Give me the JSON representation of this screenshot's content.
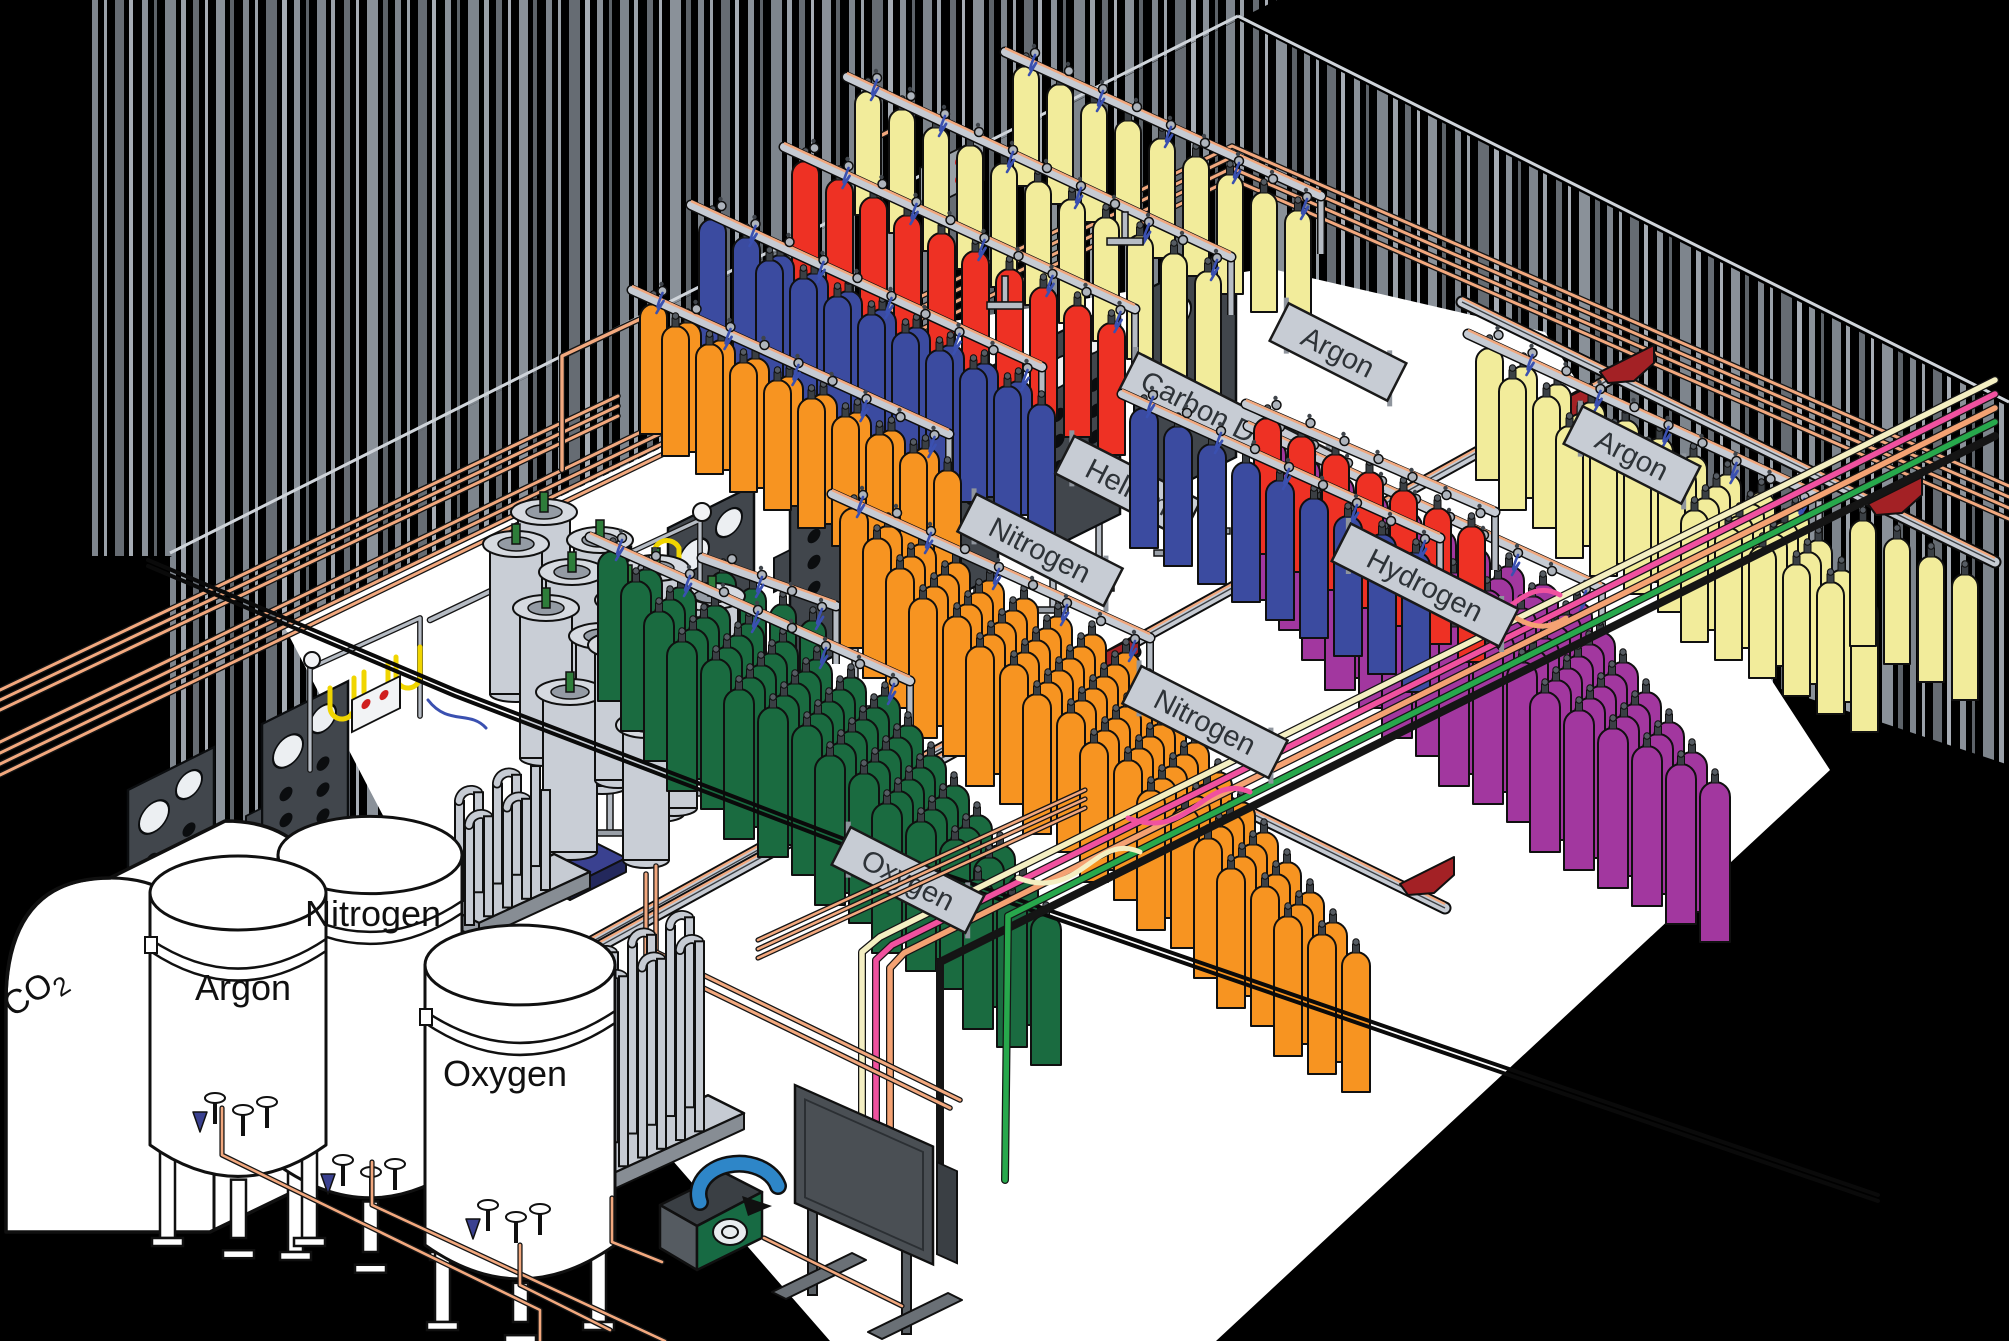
{
  "diagram": {
    "type": "isometric industrial gas cylinder filling plant",
    "description": "Warehouse with corrugated walls, rows of color-coded gas cylinder filling racks, cryogenic bulk tanks, vaporizers, dewars and overhead gas piping"
  },
  "signs": [
    {
      "id": "rack-sign-oxygen-a",
      "label": "Oxygen"
    },
    {
      "id": "rack-sign-nitrogen-a",
      "label": "Nitrogen"
    },
    {
      "id": "rack-sign-helium",
      "label": "Helium"
    },
    {
      "id": "rack-sign-carbon-dioxide",
      "label": "Carbon Dioxide"
    },
    {
      "id": "rack-sign-argon-a",
      "label": "Argon"
    },
    {
      "id": "rack-sign-oxygen-b",
      "label": "Oxygen"
    },
    {
      "id": "rack-sign-nitrogen-b",
      "label": "Nitrogen"
    },
    {
      "id": "rack-sign-hydrogen",
      "label": "Hydrogen"
    },
    {
      "id": "rack-sign-argon-b",
      "label": "Argon"
    }
  ],
  "tanks": [
    {
      "id": "tank-co2",
      "label_main": "CO",
      "label_sub": "2"
    },
    {
      "id": "tank-argon",
      "label": "Argon"
    },
    {
      "id": "tank-nitrogen",
      "label": "Nitrogen"
    },
    {
      "id": "tank-oxygen",
      "label": "Oxygen"
    }
  ],
  "colors": {
    "green": "#1A6B40",
    "orange": "#F79421",
    "blue": "#3B4BA0",
    "red": "#EE3124",
    "yellow": "#F2EC9B",
    "purple": "#A2379F",
    "copper": "#F2A87E",
    "rail": "#C6CBD3",
    "railDark": "#AEB4BC",
    "sign": "#C7CCD4",
    "signText": "#2E3338",
    "hose": "#3A50B0",
    "hopper": "#A32125",
    "pallet": "#3A4190",
    "dewar": "#C9CED6",
    "stem": "#2E7D3A",
    "pumpGreen": "#176A43",
    "pumpBlue": "#2E86C8",
    "panel": "#41464C",
    "cream": "#F4EFC2",
    "pink": "#F0519F",
    "pipeOrange": "#F4A273",
    "pipeGreen": "#27A84C",
    "floor": "#FFFFFF",
    "yellowHose": "#F0D500"
  },
  "scene": {
    "rows_a": [
      [
        "yellow",
        9,
        1285,
        330,
        -34,
        -18,
        26,
        120,
        1,
        1
      ],
      [
        "yellow",
        11,
        1195,
        395,
        -34,
        -18,
        26,
        124,
        1,
        1
      ],
      [
        "red",
        10,
        1098,
        455,
        -34,
        -18,
        27,
        132,
        1,
        1
      ],
      [
        "blue",
        10,
        1005,
        515,
        -34,
        -18,
        27,
        134,
        1,
        1
      ],
      [
        "blue",
        9,
        1028,
        538,
        -34,
        -18,
        27,
        134,
        0,
        0
      ],
      [
        "orange",
        9,
        912,
        578,
        -34,
        -18,
        27,
        130,
        1,
        1
      ],
      [
        "orange",
        9,
        934,
        600,
        -34,
        -18,
        27,
        130,
        0,
        0
      ],
      [
        "green",
        4,
        800,
        745,
        -30,
        -16,
        26,
        125,
        1,
        1
      ]
    ],
    "rows_b": [
      [
        "yellow",
        10,
        1782,
        642,
        -34,
        -18,
        27,
        132,
        1,
        1
      ],
      [
        "yellow",
        10,
        1805,
        672,
        -34,
        -18,
        27,
        132,
        0,
        0
      ],
      [
        "yellow",
        9,
        1828,
        702,
        -34,
        -18,
        27,
        132,
        0,
        0
      ],
      [
        "yellow",
        6,
        1851,
        732,
        -34,
        -18,
        27,
        132,
        0,
        0
      ],
      [
        "yellow",
        4,
        1952,
        700,
        -34,
        -18,
        26,
        126,
        0,
        0
      ],
      [
        "purple",
        10,
        1562,
        762,
        -34,
        -18,
        30,
        160,
        1,
        1
      ],
      [
        "purple",
        10,
        1585,
        792,
        -34,
        -18,
        30,
        160,
        0,
        0
      ],
      [
        "purple",
        10,
        1608,
        822,
        -34,
        -18,
        30,
        160,
        0,
        0
      ],
      [
        "purple",
        10,
        1631,
        852,
        -34,
        -18,
        30,
        160,
        0,
        0
      ],
      [
        "purple",
        9,
        1654,
        882,
        -34,
        -18,
        30,
        160,
        0,
        0
      ],
      [
        "purple",
        8,
        1677,
        912,
        -34,
        -18,
        30,
        160,
        0,
        0
      ],
      [
        "purple",
        6,
        1700,
        942,
        -34,
        -18,
        30,
        160,
        0,
        0
      ],
      [
        "red",
        7,
        1458,
        662,
        -34,
        -18,
        27,
        136,
        1,
        0
      ],
      [
        "blue",
        9,
        1402,
        692,
        -34,
        -18,
        28,
        140,
        1,
        1
      ],
      [
        "orange",
        9,
        1112,
        792,
        -34,
        -18,
        28,
        140,
        1,
        1
      ],
      [
        "orange",
        9,
        1135,
        822,
        -34,
        -18,
        28,
        140,
        0,
        0
      ],
      [
        "orange",
        9,
        1158,
        852,
        -34,
        -18,
        28,
        140,
        0,
        0
      ],
      [
        "orange",
        9,
        1181,
        882,
        -34,
        -18,
        28,
        140,
        0,
        0
      ],
      [
        "orange",
        8,
        1204,
        912,
        -34,
        -18,
        28,
        140,
        0,
        0
      ],
      [
        "orange",
        7,
        1227,
        942,
        -34,
        -18,
        28,
        140,
        0,
        0
      ],
      [
        "orange",
        6,
        1250,
        972,
        -34,
        -18,
        28,
        140,
        0,
        0
      ],
      [
        "orange",
        5,
        1273,
        1002,
        -34,
        -18,
        28,
        140,
        0,
        0
      ],
      [
        "orange",
        4,
        1296,
        1032,
        -34,
        -18,
        28,
        140,
        0,
        0
      ],
      [
        "orange",
        4,
        1319,
        1062,
        -34,
        -18,
        28,
        140,
        0,
        0
      ],
      [
        "orange",
        3,
        1342,
        1092,
        -34,
        -18,
        28,
        140,
        0,
        0
      ],
      [
        "green",
        9,
        870,
        845,
        -34,
        -18,
        30,
        150,
        1,
        1
      ],
      [
        "green",
        9,
        893,
        875,
        -34,
        -18,
        30,
        150,
        0,
        0
      ],
      [
        "green",
        9,
        916,
        905,
        -34,
        -18,
        30,
        150,
        0,
        0
      ],
      [
        "green",
        9,
        939,
        935,
        -34,
        -18,
        30,
        150,
        0,
        0
      ],
      [
        "green",
        8,
        962,
        965,
        -34,
        -18,
        30,
        150,
        0,
        0
      ],
      [
        "green",
        6,
        985,
        995,
        -34,
        -18,
        30,
        150,
        0,
        0
      ],
      [
        "green",
        5,
        1008,
        1025,
        -34,
        -18,
        30,
        150,
        0,
        0
      ],
      [
        "green",
        3,
        1031,
        1065,
        -34,
        -18,
        30,
        150,
        0,
        0
      ]
    ],
    "signs_a": [
      [
        0,
        945,
        612,
        150
      ],
      [
        1,
        1040,
        550,
        164
      ],
      [
        2,
        1128,
        487,
        142
      ],
      [
        3,
        1232,
        424,
        232
      ],
      [
        4,
        1338,
        352,
        132
      ]
    ],
    "signs_b": [
      [
        5,
        908,
        880,
        150
      ],
      [
        6,
        1205,
        722,
        164
      ],
      [
        7,
        1425,
        585,
        188
      ],
      [
        8,
        1632,
        455,
        132
      ]
    ],
    "panels": [
      [
        128,
        790
      ],
      [
        262,
        724
      ],
      [
        545,
        590
      ],
      [
        668,
        528
      ],
      [
        790,
        466
      ],
      [
        912,
        406
      ],
      [
        1034,
        345
      ],
      [
        1150,
        288
      ]
    ],
    "tracks": [
      [
        360,
        1070,
        1650,
        357
      ],
      [
        520,
        990,
        1135,
        652
      ],
      [
        1118,
        748,
        1445,
        908
      ],
      [
        1462,
        302,
        1995,
        562
      ]
    ],
    "hoppers": [
      [
        1085,
        662
      ],
      [
        1538,
        412
      ],
      [
        875,
        785
      ],
      [
        800,
        834
      ],
      [
        1400,
        884
      ],
      [
        1600,
        372
      ],
      [
        1868,
        504
      ]
    ],
    "dewars_large": [
      [
        544,
        662
      ],
      [
        600,
        690
      ],
      [
        656,
        718
      ],
      [
        712,
        746
      ],
      [
        516,
        694
      ],
      [
        572,
        722
      ],
      [
        628,
        750
      ],
      [
        684,
        778
      ],
      [
        546,
        758
      ],
      [
        602,
        786
      ],
      [
        658,
        814
      ]
    ],
    "dewars_small": [
      [
        628,
        720
      ],
      [
        684,
        748
      ],
      [
        618,
        780
      ],
      [
        674,
        808
      ],
      [
        646,
        860
      ]
    ],
    "pallet_dewar": [
      570,
      852
    ]
  }
}
